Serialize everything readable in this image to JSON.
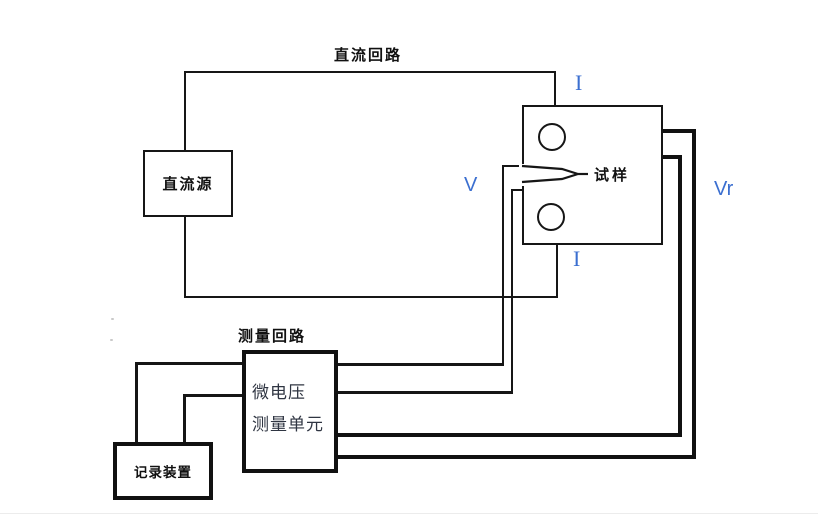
{
  "diagram": {
    "title_labels": {
      "dc_loop": "直流回路",
      "measure_loop": "测量回路"
    },
    "boxes": {
      "dc_source": "直流源",
      "specimen": "试样",
      "measure_unit_line1": "微电压",
      "measure_unit_line2": "测量单元",
      "recorder": "记录装置"
    },
    "annotations": {
      "current_top": "I",
      "current_bottom": "I",
      "voltage_probe": "V",
      "voltage_reference": "Vr"
    },
    "colors": {
      "line": "#161616",
      "thick_line": "#111111",
      "annotation_blue": "#3b6fd0",
      "measure_unit_text": "#2f3542",
      "background": "#ffffff"
    }
  }
}
